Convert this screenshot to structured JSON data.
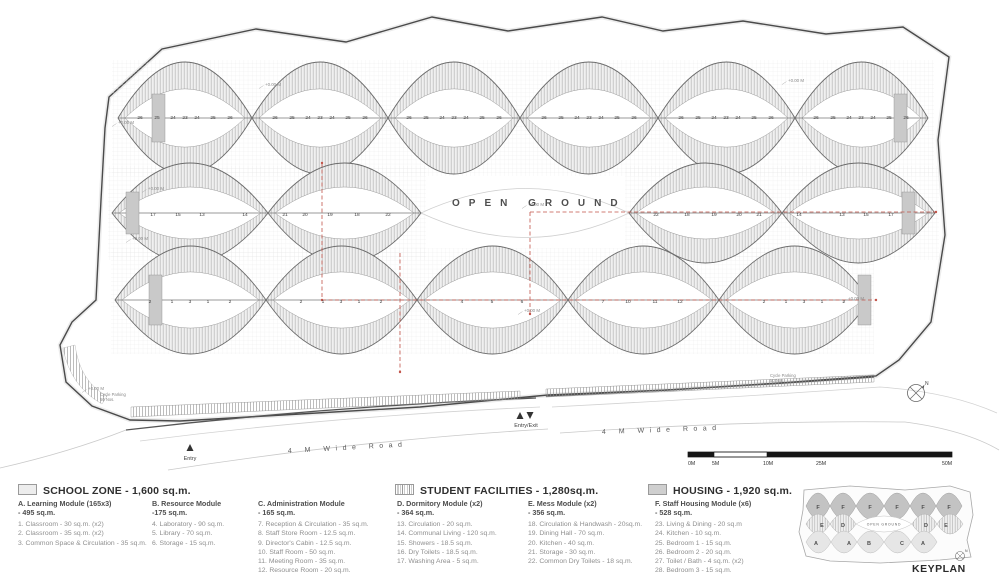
{
  "plan": {
    "open_ground": "OPEN GROUND",
    "road_label": "4 M Wide Road",
    "entry": "Entry",
    "entry_exit": "Entry/Exit",
    "cycle_parking_line1": "Cycle Parking",
    "cycle_parking_line2": "50 Nos.",
    "north": "N",
    "level_marker_text": "+0.00 M",
    "level_positions": [
      [
        265,
        86
      ],
      [
        118,
        124
      ],
      [
        148,
        190
      ],
      [
        132,
        240
      ],
      [
        88,
        390
      ],
      [
        528,
        206
      ],
      [
        524,
        312
      ],
      [
        788,
        82
      ],
      [
        848,
        300
      ]
    ],
    "rooms": {
      "housing": {
        "y": 119,
        "centers": [
          185,
          320,
          454,
          589,
          726,
          861
        ],
        "offsets": [
          -45,
          -28,
          -12,
          0,
          12,
          28,
          45
        ],
        "labels": [
          "26",
          "25",
          "24",
          "23",
          "24",
          "25",
          "26"
        ]
      },
      "facilities_left": {
        "y": 216,
        "points": [
          [
            153,
            "17"
          ],
          [
            178,
            "15"
          ],
          [
            202,
            "13"
          ],
          [
            245,
            "14"
          ],
          [
            285,
            "21"
          ],
          [
            305,
            "20"
          ],
          [
            330,
            "19"
          ],
          [
            357,
            "18"
          ],
          [
            388,
            "22"
          ]
        ]
      },
      "facilities_right": {
        "y": 216,
        "points": [
          [
            656,
            "22"
          ],
          [
            687,
            "18"
          ],
          [
            714,
            "19"
          ],
          [
            739,
            "20"
          ],
          [
            759,
            "21"
          ],
          [
            799,
            "14"
          ],
          [
            842,
            "13"
          ],
          [
            866,
            "15"
          ],
          [
            891,
            "17"
          ]
        ]
      },
      "school": {
        "y": 303,
        "points": [
          [
            150,
            "2"
          ],
          [
            172,
            "1"
          ],
          [
            190,
            "3"
          ],
          [
            208,
            "1"
          ],
          [
            230,
            "2"
          ],
          [
            301,
            "2"
          ],
          [
            323,
            "1"
          ],
          [
            341,
            "3"
          ],
          [
            359,
            "1"
          ],
          [
            381,
            "2"
          ],
          [
            462,
            "4"
          ],
          [
            492,
            "5"
          ],
          [
            522,
            "6"
          ],
          [
            603,
            "7"
          ],
          [
            628,
            "10"
          ],
          [
            655,
            "11"
          ],
          [
            680,
            "12"
          ],
          [
            764,
            "2"
          ],
          [
            786,
            "1"
          ],
          [
            804,
            "3"
          ],
          [
            822,
            "1"
          ],
          [
            844,
            "2"
          ]
        ]
      }
    }
  },
  "scalebar": {
    "ticks": [
      "0M",
      "5M",
      "10M",
      "25M",
      "50M"
    ]
  },
  "legend": {
    "sections": [
      {
        "title": "SCHOOL ZONE - 1,600 sq.m."
      },
      {
        "title": "STUDENT FACILITIES - 1,280sq.m."
      },
      {
        "title": "HOUSING - 1,920 sq.m."
      }
    ],
    "modules": [
      {
        "name": "A. Learning Module (165x3)",
        "area": "- 495 sq.m.",
        "items": [
          "1. Classroom - 30 sq.m. (x2)",
          "2. Classroom - 35 sq.m. (x2)",
          "3. Common Space & Circulation - 35 sq.m."
        ]
      },
      {
        "name": "B. Resource Module",
        "area": "-175 sq.m.",
        "items": [
          "4. Laboratory - 90 sq.m.",
          "5. Library - 70 sq.m.",
          "6. Storage - 15 sq.m."
        ]
      },
      {
        "name": "C. Administration Module",
        "area": "- 165 sq.m.",
        "items": [
          "7. Reception & Circulation - 35 sq.m.",
          "8. Staff Store Room - 12.5 sq.m.",
          "9. Director's Cabin - 12.5 sq.m.",
          "10. Staff Room - 50 sq.m.",
          "11. Meeting Room - 35 sq.m.",
          "12. Resource Room - 20 sq.m."
        ]
      },
      {
        "name": "D. Dormitory Module (x2)",
        "area": "- 364 sq.m.",
        "items": [
          "13. Circulation - 20 sq.m.",
          "14. Communal Living - 120 sq.m.",
          "15. Showers - 18.5 sq.m.",
          "16. Dry Toilets - 18.5 sq.m.",
          "17. Washing Area - 5 sq.m."
        ]
      },
      {
        "name": "E. Mess Module (x2)",
        "area": "- 356 sq.m.",
        "items": [
          "18. Circulation & Handwash - 20sq.m.",
          "19. Dining Hall - 70 sq.m.",
          "20. Kitchen - 40 sq.m.",
          "21. Storage - 30 sq.m.",
          "22. Common Dry Toilets - 18 sq.m."
        ]
      },
      {
        "name": "F. Staff Housing Module (x6)",
        "area": "- 528 sq.m.",
        "items": [
          "23. Living & Dining - 20 sq.m",
          "24. Kitchen - 10 sq.m.",
          "25. Bedroom 1 - 15 sq.m.",
          "26. Bedroom 2 - 20 sq.m.",
          "27. Toilet / Bath - 4 sq.m. (x2)",
          "28. Bedroom 3 - 15 sq.m."
        ]
      }
    ]
  },
  "keyplan": {
    "title": "KEYPLAN",
    "open_ground": "OPEN GROUND",
    "north": "N",
    "top_row": {
      "y": 509,
      "letters": [
        [
          818,
          "F"
        ],
        [
          843,
          "F"
        ],
        [
          870,
          "F"
        ],
        [
          897,
          "F"
        ],
        [
          923,
          "F"
        ],
        [
          949,
          "F"
        ]
      ]
    },
    "mid_row": {
      "y": 527,
      "letters": [
        [
          822,
          "E"
        ],
        [
          843,
          "D"
        ],
        [
          926,
          "D"
        ],
        [
          946,
          "E"
        ]
      ]
    },
    "bottom_row": {
      "y": 545,
      "letters": [
        [
          816,
          "A"
        ],
        [
          849,
          "A"
        ],
        [
          869,
          "B"
        ],
        [
          902,
          "C"
        ],
        [
          923,
          "A"
        ]
      ]
    }
  },
  "colors": {
    "section_line_red": "#c2544a",
    "housing_fill": "#c3c3c3",
    "school_fill": "#e6e6e6",
    "stripe_gray": "#b5b5b5",
    "paper": "#ffffff"
  }
}
